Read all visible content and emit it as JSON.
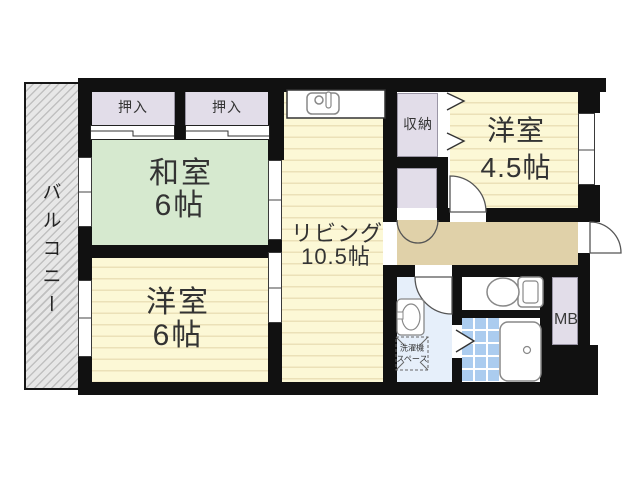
{
  "plan": {
    "type": "apartment-floor-plan",
    "rooms": {
      "balcony": "バルコニー",
      "closet_a": "押入",
      "closet_b": "押入",
      "japanese_room_name": "和室",
      "japanese_room_size": "6帖",
      "living_name": "リビング",
      "living_size": "10.5帖",
      "western6_name": "洋室",
      "western6_size": "6帖",
      "storage": "収納",
      "western45_name": "洋室",
      "western45_size": "4.5帖",
      "meter_box": "MB",
      "washer_line1": "洗濯機",
      "washer_line2": "スペース"
    },
    "colors": {
      "wall": "#111111",
      "tatami_green": "#d6e9cf",
      "flooring_yellow": "#fcf8d6",
      "flooring_stripe": "#ebe1b8",
      "closet_lavender": "#e2dde9",
      "hallway_tan": "#e0d1a9",
      "washroom_blue": "#e6effa",
      "bath_tile_blue": "#abccef",
      "balcony_gray": "#e7e7e7"
    }
  }
}
